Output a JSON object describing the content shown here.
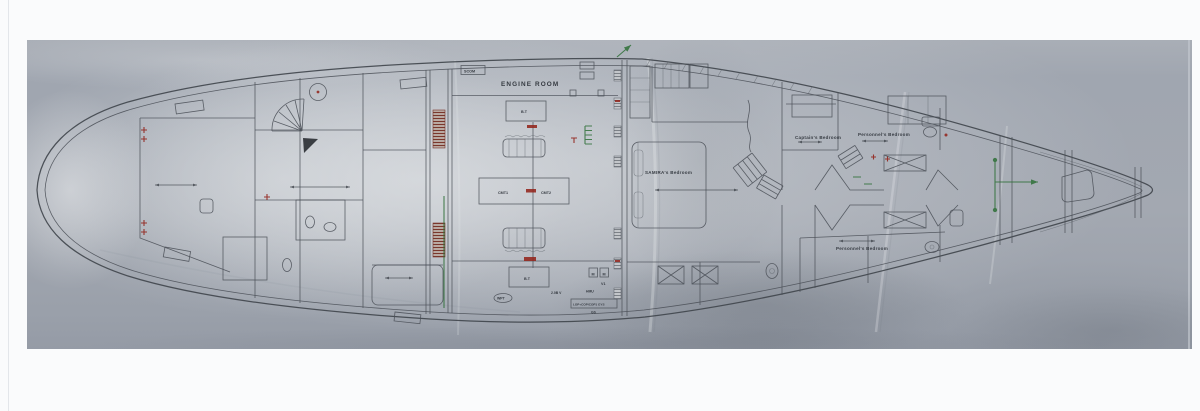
{
  "window": {
    "background": "#fafbfc"
  },
  "photo": {
    "surface_color": "#9ba2ac",
    "paper_color": "#ced2d6",
    "ink_color": "#4b5058",
    "accent_red": "#93251d",
    "accent_green": "#2f7038"
  },
  "labels": {
    "engine_room": "ENGINE ROOM",
    "samira_bedroom": "SAMIRA's Bedroom",
    "captain_bedroom": "Captain's Bedroom",
    "personnel_bedroom_upper": "Personnel's Bedroom",
    "personnel_bedroom_lower": "Personnel's Bedroom"
  },
  "equipment": {
    "scom": "SCOM",
    "bt_top": "B.T",
    "bt_bottom": "B.T",
    "cmt1": "CMT1",
    "cmt2": "CMT2",
    "wpt": "WPT",
    "motor_left": "M",
    "motor_right": "M",
    "v1": "V1",
    "hmu": "HMU",
    "voltage": "2.0B V",
    "panel": "LOP+COP/COP1 GYS",
    "gs": "GS"
  }
}
